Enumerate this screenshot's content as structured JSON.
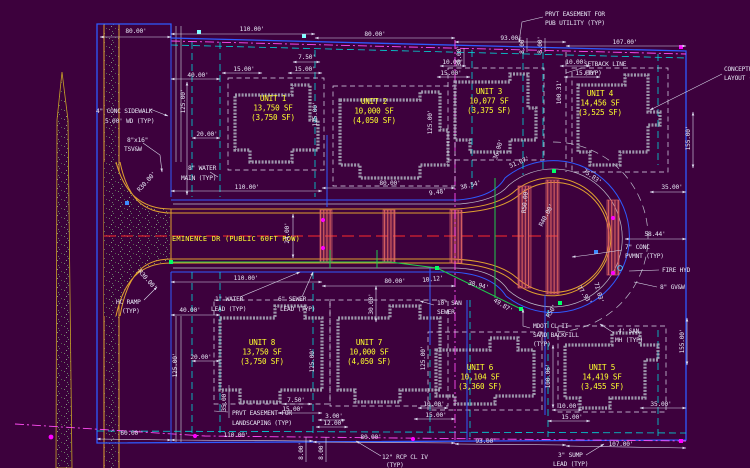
{
  "drawing": {
    "street": "EMINENCE DR (PUBLIC 60FT ROW)",
    "units": [
      {
        "name": "UNIT 1",
        "area": "13,750 SF",
        "pad": "(3,750 SF)"
      },
      {
        "name": "UNIT 2",
        "area": "10,000 SF",
        "pad": "(4,050 SF)"
      },
      {
        "name": "UNIT 3",
        "area": "10,077 SF",
        "pad": "(3,375 SF)"
      },
      {
        "name": "UNIT 4",
        "area": "14,456 SF",
        "pad": "(3,525 SF)"
      },
      {
        "name": "UNIT 5",
        "area": "14,419 SF",
        "pad": "(3,455 SF)"
      },
      {
        "name": "UNIT 6",
        "area": "10,104 SF",
        "pad": "(3,360 SF)"
      },
      {
        "name": "UNIT 7",
        "area": "10,000 SF",
        "pad": "(4,050 SF)"
      },
      {
        "name": "UNIT 8",
        "area": "13,750 SF",
        "pad": "(3,750 SF)"
      }
    ],
    "callouts": {
      "pub_utility": [
        "PRVT EASEMENT FOR",
        "PUB UTILITY (TYP)"
      ],
      "setback": [
        "SETBACK LINE",
        "(TYP)"
      ],
      "conceptual": [
        "CONCEPTUAL",
        "LAYOUT (TYP)"
      ],
      "sidewalk": [
        "4\" CONC SIDEWALK",
        "5.00' WD (TYP)"
      ],
      "tsvw": [
        "8\"x16\"",
        "TSV&W"
      ],
      "water_main": [
        "8\" WATER",
        "MAIN (TYP)"
      ],
      "hc_ramp": [
        "HC RAMP",
        "(TYP)"
      ],
      "water_lead": [
        "1\" WATER",
        "LEAD (TYP)"
      ],
      "sewer_lead": [
        "6\" SEWER",
        "LEAD (TYP)"
      ],
      "san_sewer": [
        "10\" SAN",
        "SEWER"
      ],
      "sand_backfill": [
        "MDOT CL II",
        "SAND BACKFILL",
        "(TYP)"
      ],
      "san_mh": [
        "4' SAN",
        "MH (TYP)"
      ],
      "fire_hyd": [
        "FIRE HYD"
      ],
      "gvw": [
        "8\" GV&W"
      ],
      "conc_pvmt": [
        "7\" CONC",
        "PVMNT (TYP)"
      ],
      "landscaping": [
        "PRVT EASEMENT FOR",
        "LANDSCAPING (TYP)"
      ],
      "rcp": [
        "12\" RCP CL IV",
        "(TYP)"
      ],
      "sump_lead": [
        "3\" SUMP",
        "LEAD (TYP)"
      ]
    },
    "dims": {
      "top_80": "80.00'",
      "top_110": "110.00'",
      "top_80b": "80.00'",
      "top_93": "93.00'",
      "top_107": "107.00'",
      "left_40": "40.00'",
      "left_20": "20.00'",
      "u1_750": "7.50'",
      "u1_15": "15.00'",
      "u1_15l": "15.00'",
      "u2_10": "10.00'",
      "u2_15": "15.00'",
      "u4_10": "10.00'",
      "u4_15": "15.00'",
      "v125a": "125.00'",
      "v125b": "125.00'",
      "v125c": "125.00'",
      "v35t": "35.00'",
      "v8a": "8.00'",
      "v8b": "8.00'",
      "v100_31": "100.31'",
      "v155t": "155.00'",
      "right_35": "35.00'",
      "row_110": "110.00'",
      "row_80": "80.00'",
      "row_948": "9.48'",
      "row_3854": "38.54'",
      "row_5107": "51.07'",
      "row_36": "36.00'",
      "row_7583": "75.83'",
      "row_5844": "58.44'",
      "r50": "R50.00'",
      "r40": "R40.00'",
      "v24": "24.00'",
      "r30a": "R30.00'",
      "r30b": "R30.00'",
      "brow_110": "110.00'",
      "brow_80": "80.00'",
      "b_1012": "10.12'",
      "b_3894": "38.94'",
      "b_4987": "49.87'",
      "b_r50": "R50'",
      "b_7793": "77.93'",
      "b_7103": "71.03'",
      "bot_40": "40.00'",
      "bot_20": "20.00'",
      "v30": "30.00'",
      "v125d": "125.00'",
      "v125e": "125.00'",
      "v125f": "125.00'",
      "v100_06": "100.06'",
      "v35b": "35.00'",
      "v8c": "8.00'",
      "v8d": "8.00'",
      "v155b": "155.00'",
      "bot_750": "7.50'",
      "bot_15a": "15.00'",
      "bot_3": "3.00'",
      "bot_12": "12.00'",
      "bot_10a": "10.00'",
      "bot_15b": "15.00'",
      "bot_10b": "10.00'",
      "bot_15c": "15.00'",
      "bot_35": "35.00'",
      "bot_60": "60.00'",
      "bot_110": "110.00'",
      "bot_80": "80.00'",
      "bot_93": "93.00'",
      "bot_107": "107.00'"
    },
    "colors": {
      "background": "#3D013D",
      "boundary_blue": "#2E5BFF",
      "easement_cyan": "#00D9D9",
      "easement_magenta": "#FF4DF2",
      "curb_orange": "#E0A030",
      "dim_white": "#E6E6F4",
      "unit_yellow": "#FFFF2E",
      "centerline_red": "#FF2A2A",
      "utility_green": "#1FCC4D",
      "pavement_hatch": "#E06868"
    }
  }
}
